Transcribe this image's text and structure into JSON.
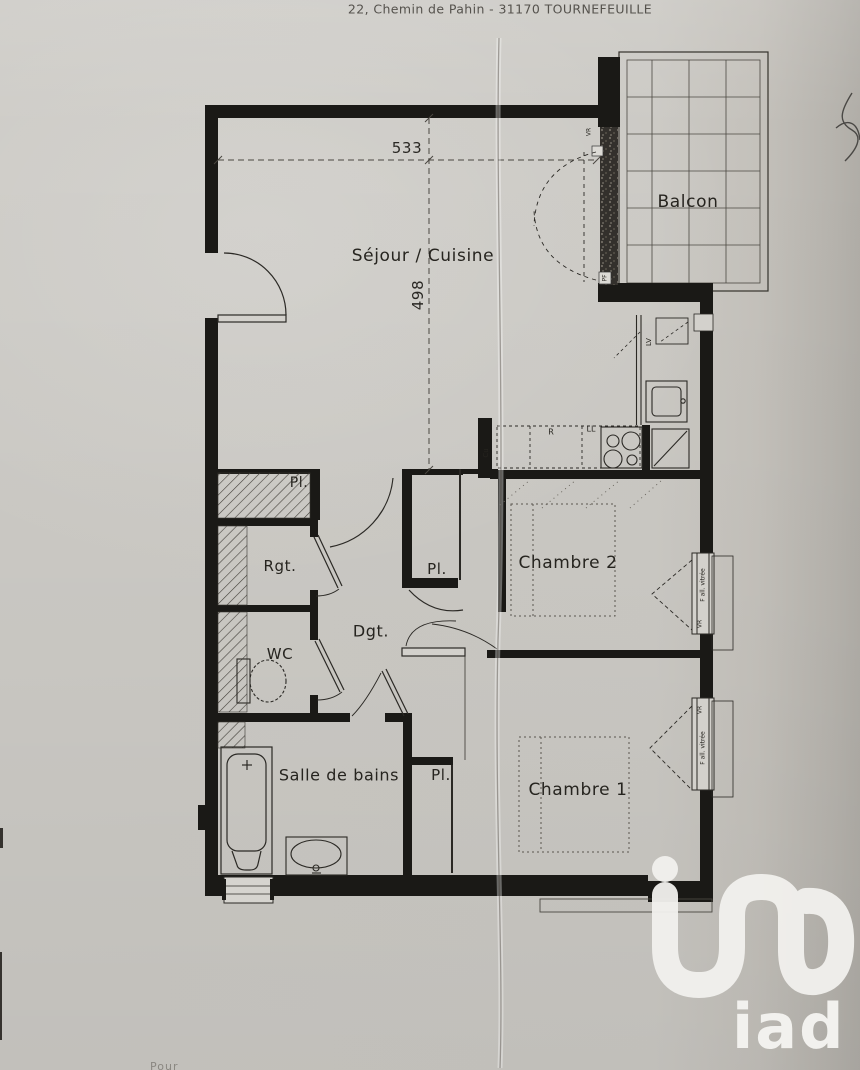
{
  "header": {
    "address": "22, Chemin de Pahin - 31170 TOURNEFEUILLE"
  },
  "floorplan": {
    "rooms": {
      "sejour": {
        "label": "Séjour / Cuisine"
      },
      "balcon": {
        "label": "Balcon"
      },
      "chambre1": {
        "label": "Chambre 1"
      },
      "chambre2": {
        "label": "Chambre 2"
      },
      "sdb": {
        "label": "Salle de bains"
      },
      "wc": {
        "label": "WC"
      },
      "rgt": {
        "label": "Rgt."
      },
      "dgt": {
        "label": "Dgt."
      },
      "placard": {
        "label": "Pl."
      }
    },
    "dimensions": {
      "width": "533",
      "depth": "498"
    },
    "appliances": {
      "dishwasher": "LV",
      "fridge": "R",
      "washer": "LL",
      "kitchen": "Cu"
    },
    "openings": {
      "shutter": "VR",
      "bay": "PF",
      "window": "F all. vitrée"
    },
    "colors": {
      "paper": "#cbc9c4",
      "ink": "#1a1916",
      "logo": "#f2f1ee"
    }
  },
  "branding": {
    "logo": "iad"
  },
  "footer": {
    "fragment": "Pour"
  }
}
